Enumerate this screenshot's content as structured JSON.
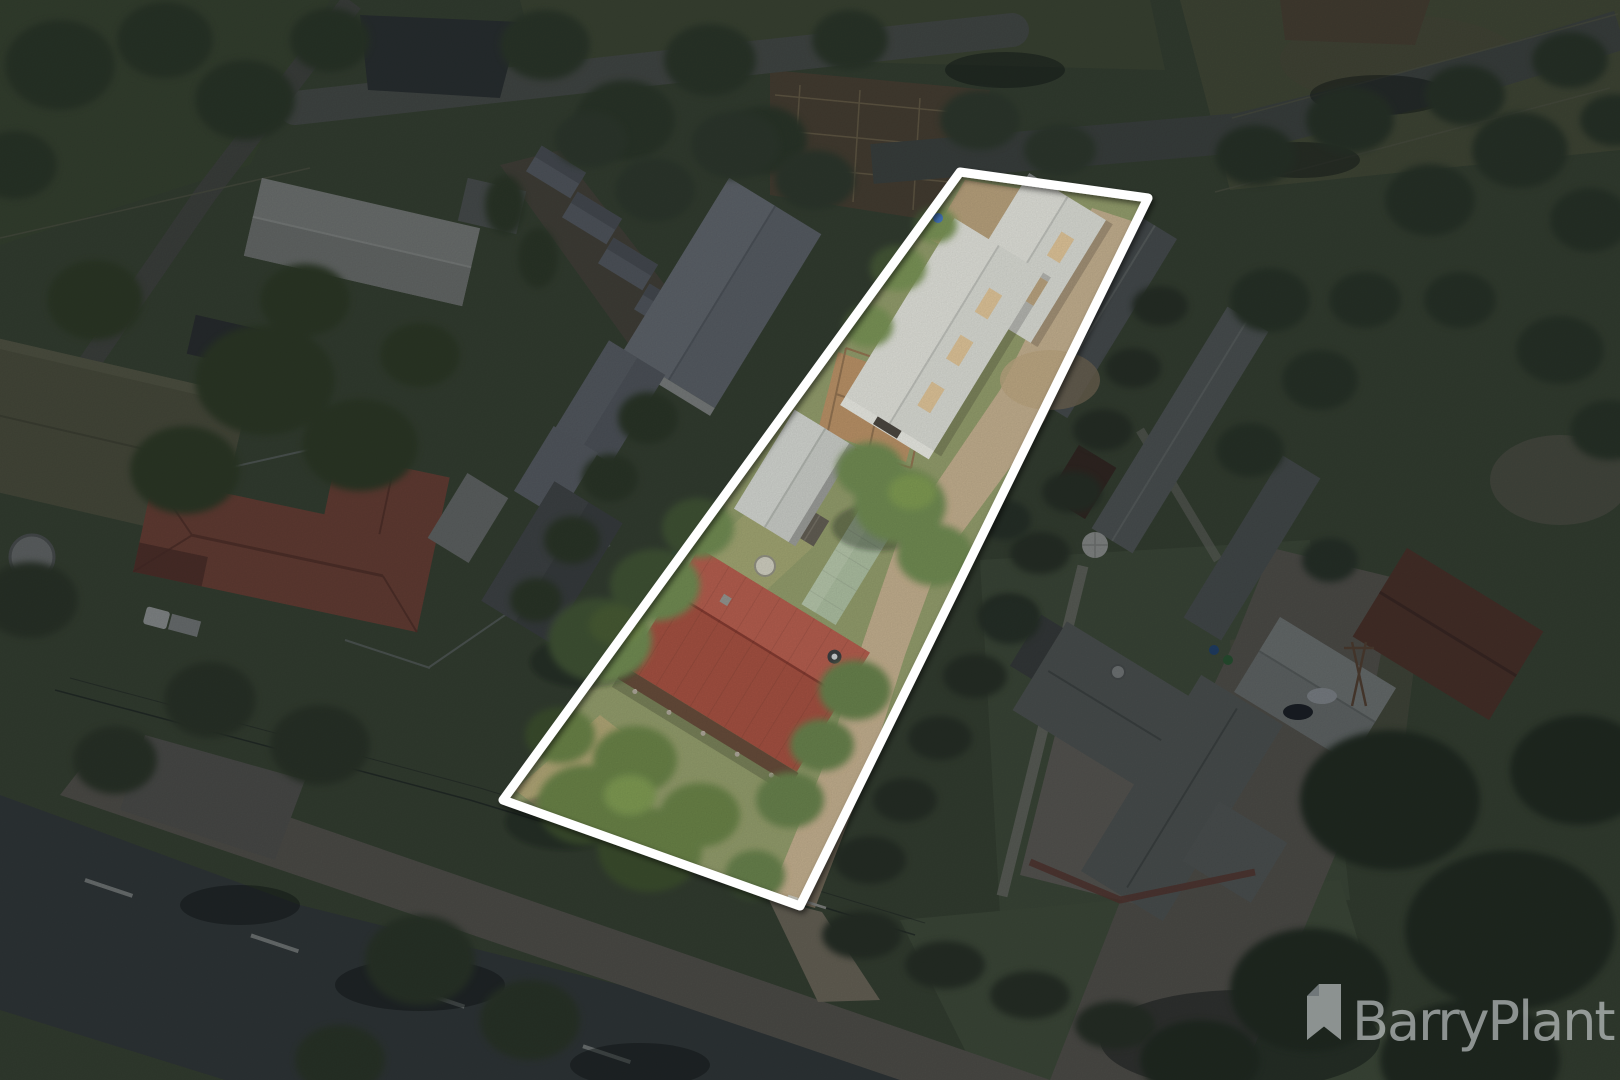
{
  "meta": {
    "asset_type": "real-estate aerial drone photograph",
    "scene_summary": "Aerial view of a long narrow country allotment outlined in white. The highlighted lot contains a red corrugated-iron cottage with veranda, a carport, a green-roofed outbuilding, a horse yard and two large white machinery sheds, linked by a gravel driveway. Surrounding houses, sheds, stables, paddocks, tree rows and roads are dimmed outside the boundary.",
    "canvas": {
      "width_px": 1620,
      "height_px": 1080
    }
  },
  "branding": {
    "agency_name": "BarryPlant",
    "logo_icon": "ribbon-bookmark-icon",
    "watermark_color": "#e9edf0",
    "watermark_opacity": "0.55"
  },
  "highlight": {
    "boundary_color": "#ffffff",
    "boundary_stroke_px": "9",
    "dim_color": "rgba(10,16,22,0.45)",
    "lot_corners_px": "960,172 1148,198 800,906 503,800"
  },
  "scene": {
    "landmarks": [
      "highlighted allotment with white boundary",
      "red corrugated-iron house with veranda and satellite dish",
      "two white machinery sheds with skylights",
      "grey carport and pale-green outbuilding",
      "horse yard with timber rails and horse",
      "gravel driveway to front gate",
      "asphalt road with dashed centreline (bottom left)",
      "gravel frontage road",
      "neighbouring terracotta-tile house with white ute",
      "neighbouring olive-roofed house and water tank",
      "neighbouring grey sheds and stock stalls",
      "stable rows and dark barn (right)",
      "large homestead with carport and rust-red shed (bottom right)",
      "stockyards and paddocks (top)",
      "tree rows and windbreaks"
    ],
    "colors": {
      "grass_base": "#4f5d41",
      "lot_grass": "#8a9563",
      "dry_grass": "#a89f6e",
      "dirt_driveway": "#bca887",
      "asphalt_road": "#474e4c",
      "gravel_road": "#7b7669",
      "main_house_roof": "#9c4637",
      "shed_roof": "#d3d6d0",
      "skylight": "#d9bf92",
      "terracotta_roof": "#a05b46",
      "homestead_roof": "#757a74",
      "rust_shed_roof": "#6e4433",
      "tree_dark": "#3c4a31",
      "tree_bright": "#66834a"
    }
  }
}
